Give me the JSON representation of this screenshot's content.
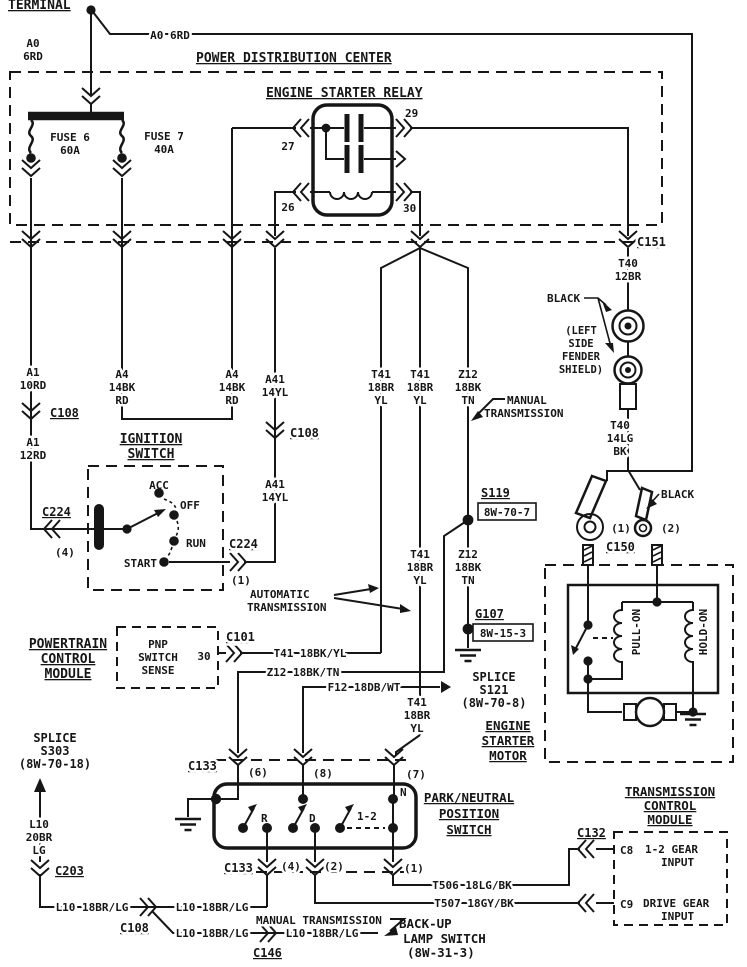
{
  "top": {
    "terminal": "TERMINAL",
    "a0": "A0 6RD",
    "a0_1": "A0",
    "a0_2": "6RD"
  },
  "pdc": {
    "title": "POWER DISTRIBUTION CENTER",
    "f6": "FUSE 6",
    "f6a": "60A",
    "f7": "FUSE 7",
    "f7a": "40A"
  },
  "relay": {
    "title": "ENGINE STARTER RELAY",
    "p27": "27",
    "p29": "29",
    "p26": "26",
    "p30": "30"
  },
  "right": {
    "c151": "C151",
    "t40a": [
      "T40",
      "12BR"
    ],
    "black": "BLACK",
    "fender": [
      "(LEFT",
      "SIDE",
      "FENDER",
      "SHIELD)"
    ],
    "t40b": [
      "T40",
      "14LG",
      "BK"
    ],
    "p1": "(1)",
    "p2": "(2)",
    "c150": "C150"
  },
  "sol": {
    "pull": "PULL-ON",
    "hold": "HOLD-ON",
    "title": [
      "ENGINE",
      "STARTER",
      "MOTOR"
    ]
  },
  "left": {
    "a1a": [
      "A1",
      "10RD"
    ],
    "c108": "C108",
    "a1b": [
      "A1",
      "12RD"
    ],
    "c224": "C224",
    "p4": "(4)"
  },
  "a4": [
    "A4",
    "14BK",
    "RD"
  ],
  "a41": [
    "A41",
    "14YL"
  ],
  "ign": {
    "t1": "IGNITION",
    "t2": "SWITCH",
    "acc": "ACC",
    "off": "OFF",
    "run": "RUN",
    "start": "START",
    "c224": "C224",
    "p1": "(1)"
  },
  "mid": {
    "t41": [
      "T41",
      "18BR",
      "YL"
    ],
    "z12": [
      "Z12",
      "18BK",
      "TN"
    ],
    "man": [
      "MANUAL",
      "TRANSMISSION"
    ],
    "auto": [
      "AUTOMATIC",
      "TRANSMISSION"
    ],
    "s119": "S119",
    "s119r": "8W-70-7",
    "g107": "G107",
    "g107r": "8W-15-3"
  },
  "pcm": {
    "title": [
      "POWERTRAIN",
      "CONTROL",
      "MODULE"
    ],
    "pnp": [
      "PNP",
      "SWITCH",
      "SENSE"
    ],
    "p30": "30",
    "c101": "C101",
    "t41": "T41 18BK/YL",
    "z12": "Z12 18BK/TN",
    "f12": "F12 18DB/WT"
  },
  "s121": [
    "SPLICE",
    "S121",
    "(8W-70-8)"
  ],
  "s303": [
    "SPLICE",
    "S303",
    "(8W-70-18)"
  ],
  "l10v": [
    "L10",
    "20BR",
    "LG"
  ],
  "c203": "C203",
  "pnp": {
    "c133": "C133",
    "p6": "(6)",
    "p8": "(8)",
    "p7": "(7)",
    "title": [
      "PARK/NEUTRAL",
      "POSITION",
      "SWITCH"
    ],
    "r": "R",
    "d": "D",
    "g": "1-2",
    "n": "N",
    "p4": "(4)",
    "p2": "(2)",
    "p1": "(1)"
  },
  "bot": {
    "t506": "T506 18LG/BK",
    "t507": "T507 18GY/BK",
    "l10": "L10 18BR/LG",
    "c108": "C108",
    "c146": "C146",
    "man": "MANUAL TRANSMISSION",
    "backup": [
      "BACK-UP",
      "LAMP SWITCH",
      "(8W-31-3)"
    ]
  },
  "tcm": {
    "title": [
      "TRANSMISSION",
      "CONTROL",
      "MODULE"
    ],
    "c132": "C132",
    "c8": "C8",
    "c8a": "1-2 GEAR",
    "c8b": "INPUT",
    "c9": "C9",
    "c9a": "DRIVE GEAR",
    "c9b": "INPUT"
  }
}
